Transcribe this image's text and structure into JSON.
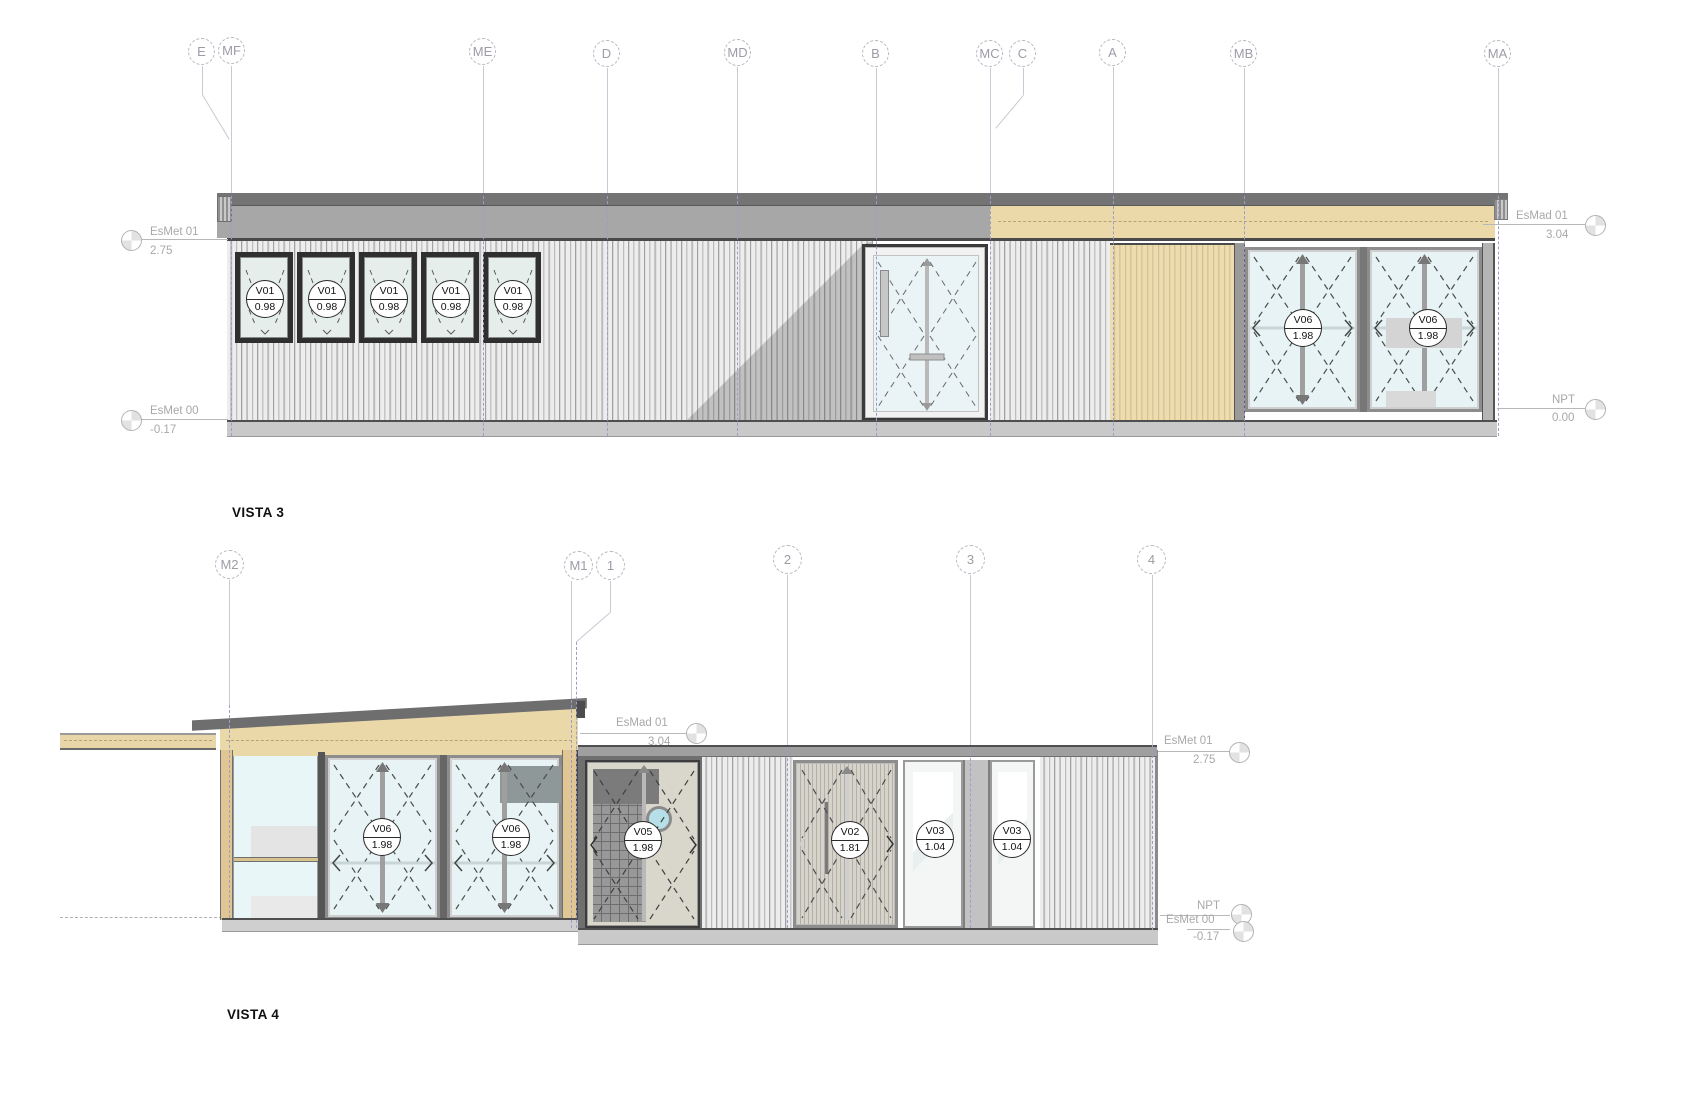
{
  "view_labels": {
    "vista3": "VISTA 3",
    "vista4": "VISTA 4"
  },
  "grids_top": [
    {
      "label": "E"
    },
    {
      "label": "MF"
    },
    {
      "label": "ME"
    },
    {
      "label": "D"
    },
    {
      "label": "MD"
    },
    {
      "label": "B"
    },
    {
      "label": "MC"
    },
    {
      "label": "C"
    },
    {
      "label": "A"
    },
    {
      "label": "MB"
    },
    {
      "label": "MA"
    }
  ],
  "grids_bottom": [
    {
      "label": "M2"
    },
    {
      "label": "M1"
    },
    {
      "label": "1"
    },
    {
      "label": "2"
    },
    {
      "label": "3"
    },
    {
      "label": "4"
    }
  ],
  "levels": {
    "esmet01": {
      "name": "EsMet 01",
      "value": "2.75"
    },
    "esmet00": {
      "name": "EsMet 00",
      "value": "-0.17"
    },
    "esmad01": {
      "name": "EsMad 01",
      "value": "3.04"
    },
    "npt": {
      "name": "NPT",
      "value": "0.00"
    }
  },
  "window_tags": {
    "v01": {
      "code": "V01",
      "value": "0.98"
    },
    "v02": {
      "code": "V02",
      "value": "1.81"
    },
    "v03": {
      "code": "V03",
      "value": "1.04"
    },
    "v05": {
      "code": "V05",
      "value": "1.98"
    },
    "v06": {
      "code": "V06",
      "value": "1.98"
    }
  },
  "colors": {
    "roof_dark": "#757575",
    "fascia_gray": "#a7a7a7",
    "wood_tan": "#ecd9a9",
    "glass_blue": "#e9f3f6",
    "siding_light": "#ededed",
    "base_gray": "#c9c9c9",
    "grid_lavender": "#9d9dc8",
    "annotation_gray": "#a8a8a8"
  }
}
